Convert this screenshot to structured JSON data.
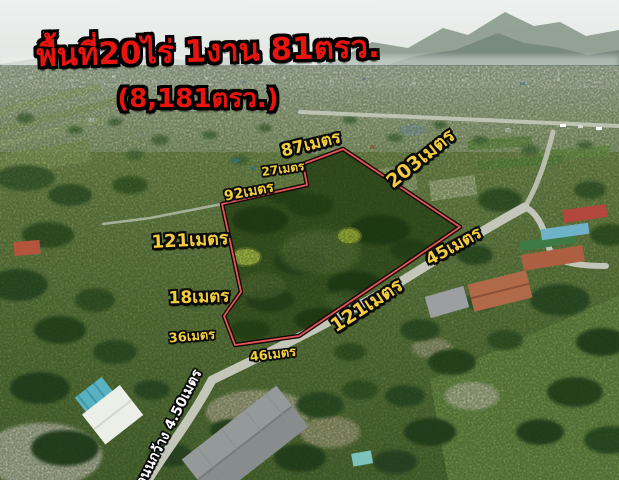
{
  "listing": {
    "title": "พื้นที่20ไร่ 1งาน 81ตรว.",
    "subtitle": "(8,181ตรว.)"
  },
  "boundary_labels": [
    {
      "id": "top-87m",
      "text": "87เมตร"
    },
    {
      "id": "top-inner-27m",
      "text": "27เมตร"
    },
    {
      "id": "upper-left-92m",
      "text": "92เมตร"
    },
    {
      "id": "right-upper-203m",
      "text": "203เมตร"
    },
    {
      "id": "left-121m",
      "text": "121เมตร"
    },
    {
      "id": "left-lower-18m",
      "text": "18เมตร"
    },
    {
      "id": "left-bottom-36m",
      "text": "36เมตร"
    },
    {
      "id": "bottom-46m",
      "text": "46เมตร"
    },
    {
      "id": "bottom-right-121m",
      "text": "121เมตร"
    },
    {
      "id": "right-45m",
      "text": "45เมตร"
    }
  ],
  "road_label": {
    "text": "ถนนกว้าง 4.50เมตร"
  },
  "colors": {
    "title_text": "#e8150f",
    "measurement_text": "#f2cd3e",
    "road_text": "#ffffff",
    "boundary_line": "#e05858",
    "boundary_outline": "#190606"
  }
}
